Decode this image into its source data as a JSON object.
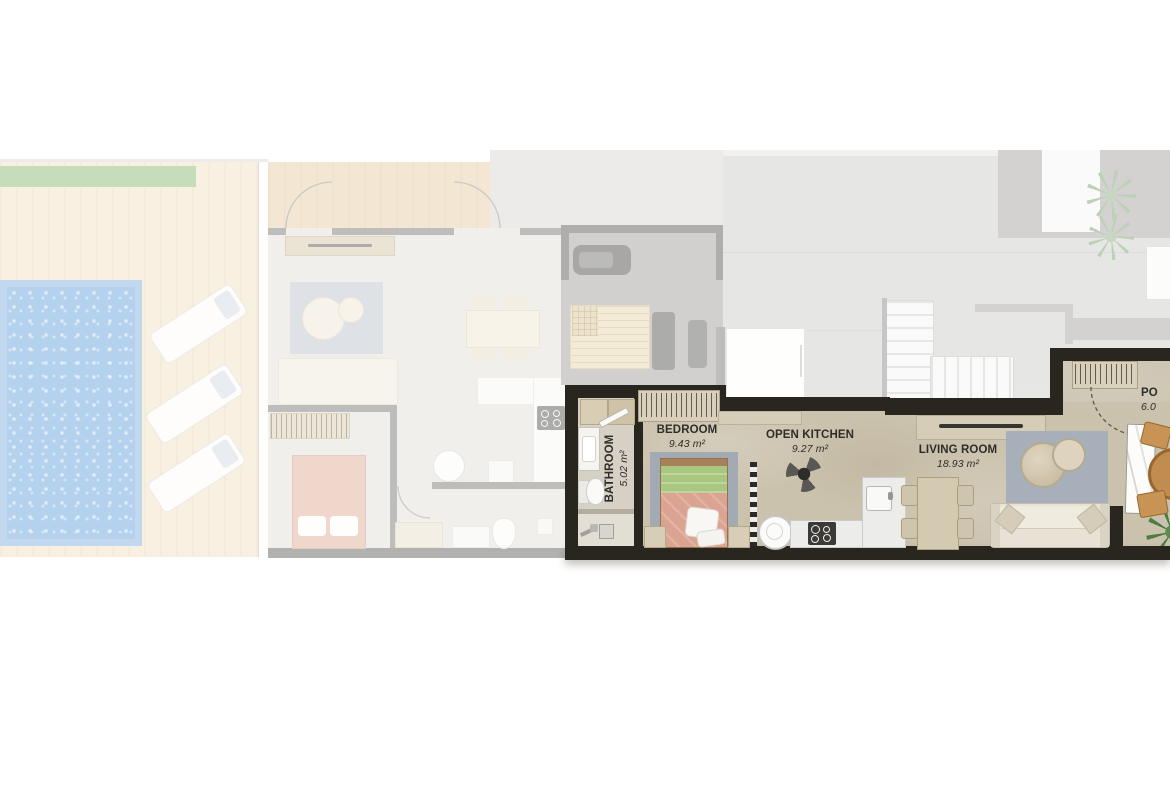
{
  "rooms": {
    "bathroom": {
      "name": "BATHROOM",
      "area": "5.02 m²"
    },
    "bedroom": {
      "name": "BEDROOM",
      "area": "9.43 m²"
    },
    "kitchen": {
      "name": "OPEN KITCHEN",
      "area": "9.27 m²"
    },
    "living": {
      "name": "LIVING ROOM",
      "area": "18.93 m²"
    },
    "porch": {
      "name": "PO",
      "area": "6.0"
    }
  },
  "colors": {
    "active_wall": "#29261f",
    "active_floor": "#cbc2ad",
    "pool_water": "#b5d2ee",
    "grass": "#c8dcba",
    "bed_blanket": "#dba492",
    "bed_throw_green": "#a9c77f",
    "rug": "#a7b0ba",
    "outdoor_wood": "#c08c4f",
    "plant": "#4e7d44",
    "label_text": "#2e2d29"
  }
}
